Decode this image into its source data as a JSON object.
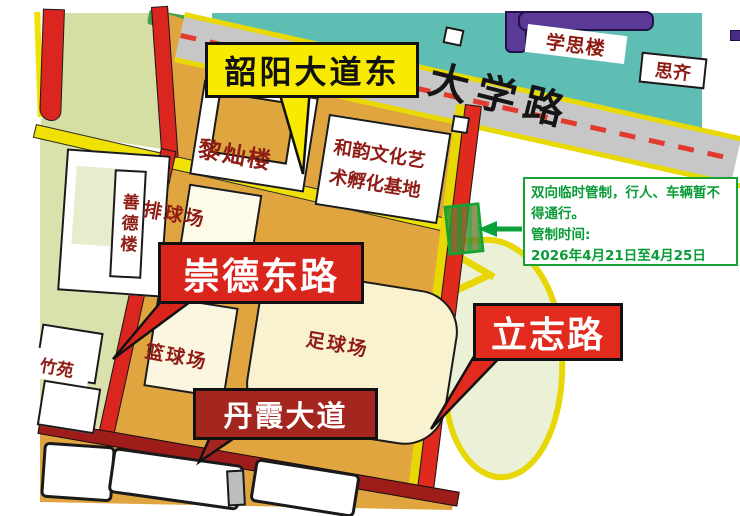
{
  "roads": {
    "daxue": "大学路",
    "shaoyang": "韶阳大道东",
    "chongde": "崇德东路",
    "danxia": "丹霞大道",
    "lizhi": "立志路"
  },
  "places": {
    "lican": "黎灿楼",
    "heyun_line1": "和韵文化艺",
    "heyun_line2": "术孵化基地",
    "shande": "善德楼",
    "xuesi": "学思楼",
    "siqi": "思齐",
    "zhuyuan": "竹苑",
    "volleyball": "排球场",
    "basketball": "篮球场",
    "football": "足球场"
  },
  "annotation": {
    "line1": "双向临时管制，行人、车辆暂不",
    "line2": "得通行。",
    "line3": "管制时间:",
    "line4": "2026年4月21日至4月25日"
  },
  "colors": {
    "campus_tan": "#E0A53F",
    "teal": "#5EBEB4",
    "lawn_green": "#D5DFA3",
    "road_red": "#DB2620",
    "road_dark_red": "#9E1D1A",
    "road_yellow": "#EFE103",
    "road_gray": "#C7C7C7",
    "purple_road": "#5A3A96",
    "callout_yellow": "#F8EA00",
    "callout_red": "#DA251D",
    "callout_dark_red": "#A3261F",
    "annotation_green": "#17A231",
    "label_maroon": "#8F1D15"
  }
}
